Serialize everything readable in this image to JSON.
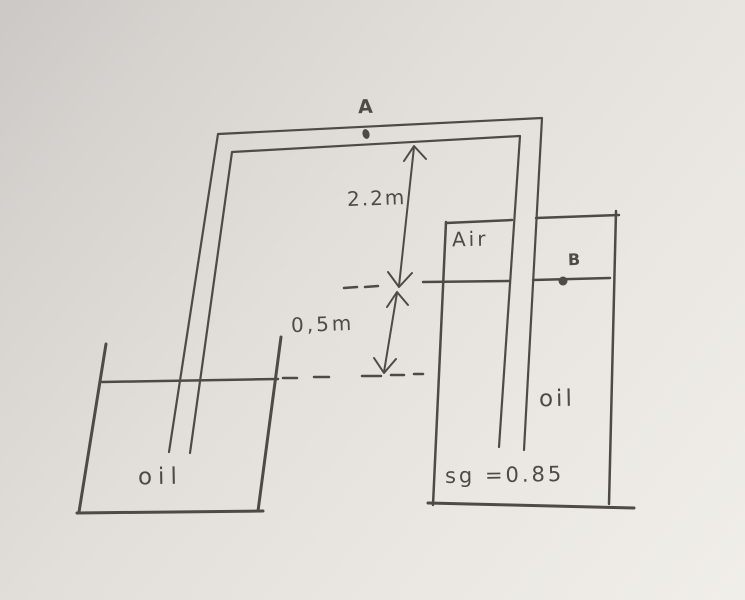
{
  "diagram": {
    "description": "hand-drawn two-tank inverted U-tube manometer problem",
    "points": {
      "a": "A",
      "b": "B"
    },
    "regions": {
      "air_pocket": "Air",
      "left_tank_fluid": "oil",
      "right_tank_fluid": "oil"
    },
    "annotations": {
      "specific_gravity": "sg =0.85"
    },
    "dimensions": {
      "upper_height": "2.2m",
      "lower_height": "0,5m"
    }
  },
  "colors": {
    "ink": "#4e4b47",
    "paper_dark": "#cbc8c5",
    "paper_mid": "#e2dfda",
    "paper_light": "#f0eee9"
  }
}
